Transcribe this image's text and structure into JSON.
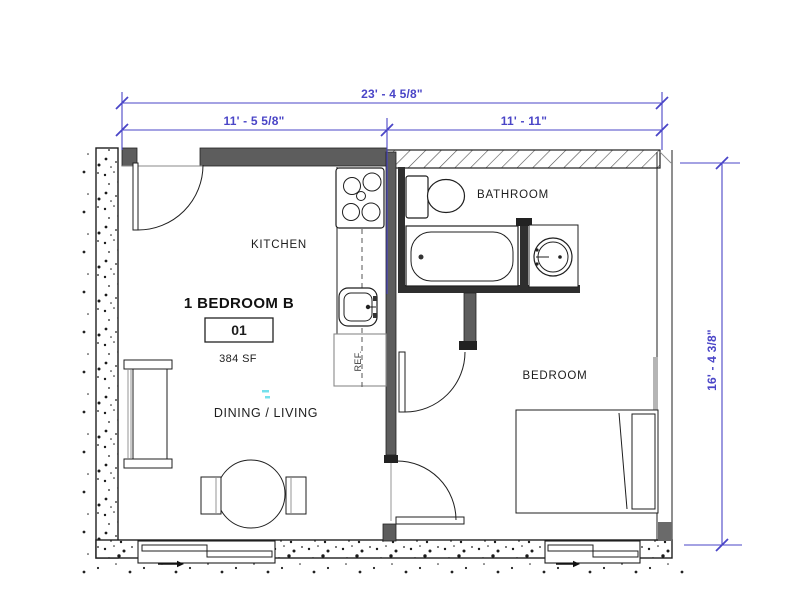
{
  "plan": {
    "unit_type_label": "1 BEDROOM B",
    "unit_number": "01",
    "area_label": "384 SF",
    "rooms": {
      "kitchen": "KITCHEN",
      "bathroom": "BATHROOM",
      "bedroom": "BEDROOM",
      "dining_living": "DINING / LIVING"
    },
    "appliances": {
      "refrigerator": "REF."
    },
    "dimensions": {
      "overall_width": "23' - 4 5/8\"",
      "kitchen_side_width": "11' - 5 5/8\"",
      "bedroom_side_width": "11' - 11\"",
      "overall_depth": "16' - 4 3/8\""
    },
    "colors": {
      "dimension_blue": "#4a45c7",
      "wall_gray": "#5d5d5d",
      "line_black": "#1f1f1f"
    }
  }
}
